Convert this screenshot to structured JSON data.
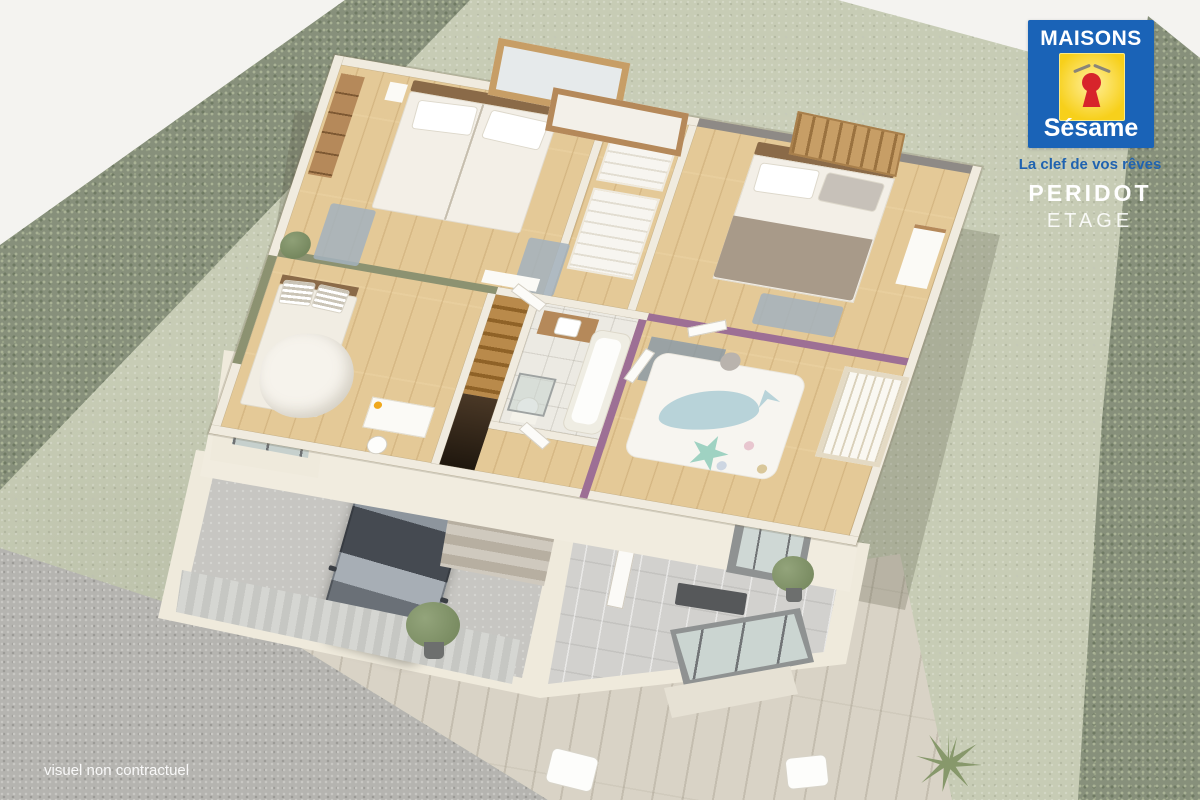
{
  "brand": {
    "name_top": "MAISONS",
    "name_bottom": "Sésame",
    "tagline": "La clef de vos rêves",
    "colors": {
      "blue": "#1A63B7",
      "yellow": "#F7D01B",
      "red": "#D7242B",
      "white": "#FFFFFF"
    }
  },
  "plan": {
    "title": "PERIDOT",
    "subtitle": "ETAGE"
  },
  "footer": {
    "disclaimer": "visuel non contractuel"
  },
  "scene": {
    "type": "3d-isometric-floor-plan-render",
    "floor_shown": "upper floor (étage) cutaway over ground floor",
    "palette": {
      "grass": "#C7CCB5",
      "hedge": "#87907B",
      "wood_floor": "#E4C997",
      "walls_cream": "#F0EBDF",
      "accent_wall_green": "#8C9271",
      "accent_wall_purple": "#9D6F95",
      "back_wall_gray": "#8E8A86",
      "bath_tile": "#ECEAE3",
      "deck_wood": "#D9D3C6",
      "gravel": "#B5B4B0",
      "car_gray": "#62686F",
      "logo_blue": "#1A63B7"
    },
    "rooms": [
      "master-bedroom",
      "bedroom-2",
      "bedroom-3",
      "child-bedroom",
      "bathroom",
      "dressing",
      "stair-landing"
    ],
    "ground_floor_elements": [
      "garage",
      "car",
      "garage-door",
      "entry-hall",
      "terrace-deck",
      "gravel-driveway",
      "bay-window"
    ]
  }
}
